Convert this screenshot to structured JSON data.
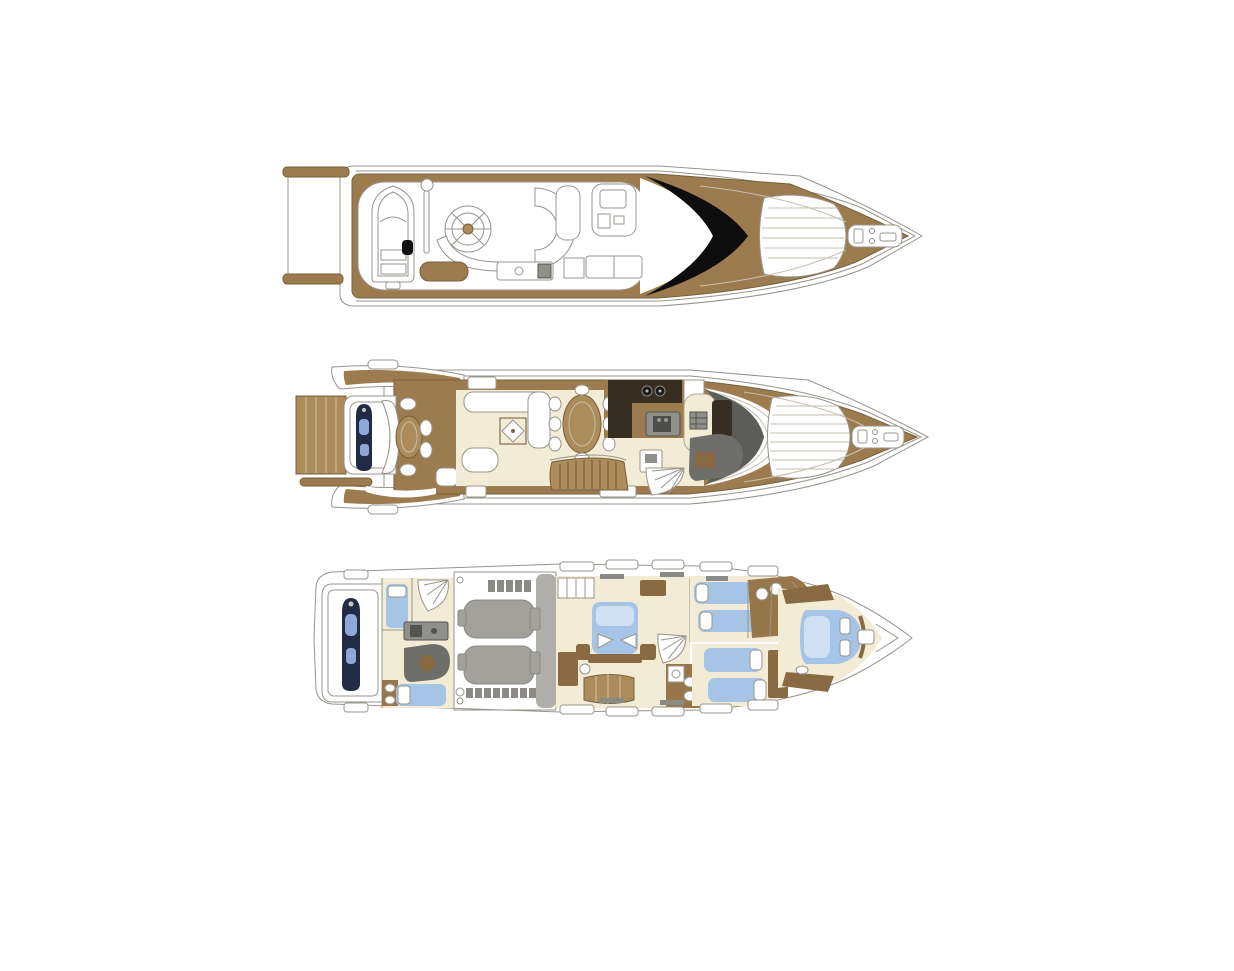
{
  "page": {
    "background": "#ffffff",
    "description_semantic": "three-deck-motor-yacht-floor-plan"
  },
  "decks": [
    {
      "id": "flybridge-deck",
      "order": 1
    },
    {
      "id": "main-deck",
      "order": 2
    },
    {
      "id": "lower-deck",
      "order": 3
    }
  ],
  "colors": {
    "teak": "#9c7c4f",
    "teak_light": "#ac8c5a",
    "wood": "#8a6a42",
    "floor_cream": "#f2ebd6",
    "bed_blue": "#a6c4e6",
    "bed_blue_light": "#cfe1f3",
    "jetski_navy": "#222b46",
    "jetski_glass": "#8fa8d8",
    "windshield_black": "#0d0d0d",
    "helm_gray": "#5c5c59",
    "sofa_gray": "#6e6f6b",
    "engine_floor": "#d6d5d0",
    "engine_gray": "#a2a19c",
    "bulkhead_gray": "#b0aea8",
    "galley_dark": "#372e23",
    "counter_gray": "#8f8f8b",
    "bath_floor": "#97764a",
    "fixture_white": "#ffffff",
    "outline_gray": "#98948c"
  }
}
